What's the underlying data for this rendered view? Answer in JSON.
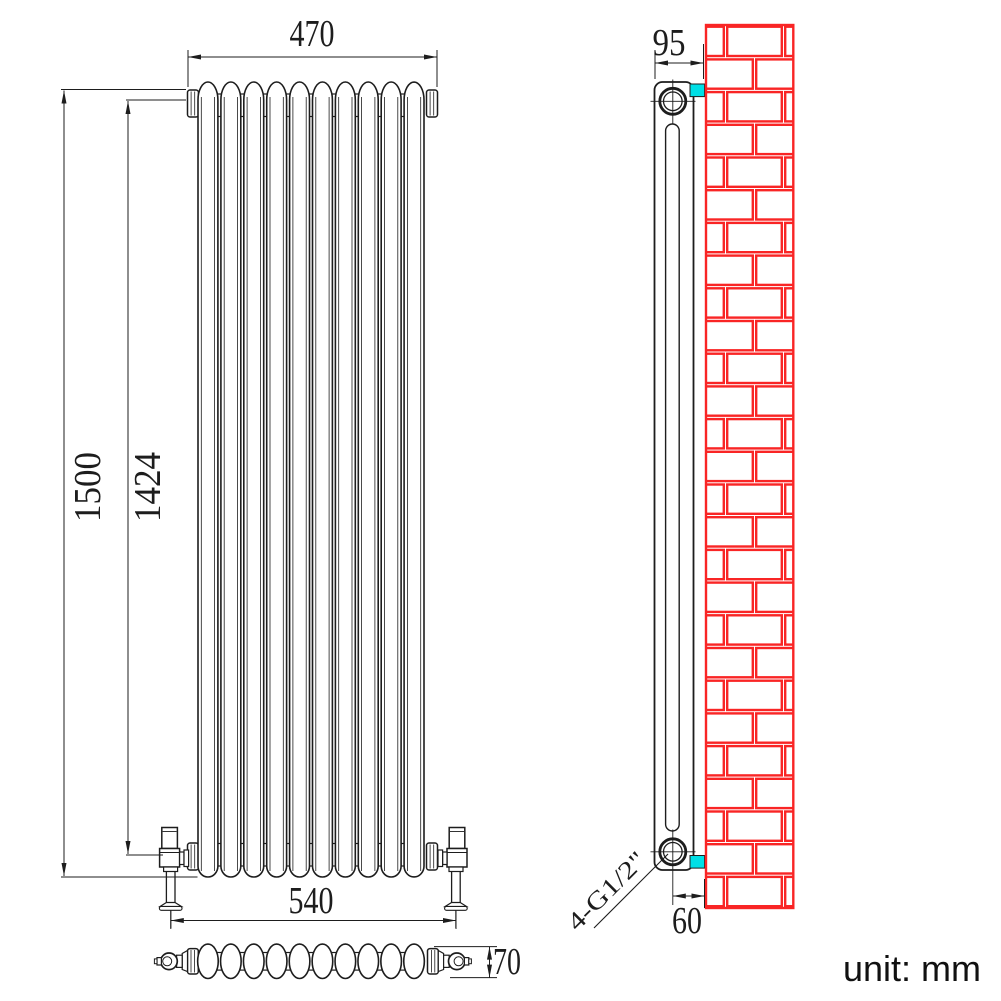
{
  "unit_label": "unit: mm",
  "dimensions": {
    "front_width": "470",
    "overall_height": "1500",
    "tapping_centres_height": "1424",
    "pipe_centres_width": "540",
    "depth": "70",
    "side_width": "95",
    "wall_to_pipe_centre": "60",
    "connections": "4-G1/2\""
  },
  "colors": {
    "line": "#1d1d1d",
    "brick": "#f92525",
    "bracket": "#00dfe6",
    "background": "#ffffff"
  },
  "front_view": {
    "columns": 10
  },
  "plan_view": {
    "columns": 10
  },
  "wall": {
    "rows": 27
  }
}
